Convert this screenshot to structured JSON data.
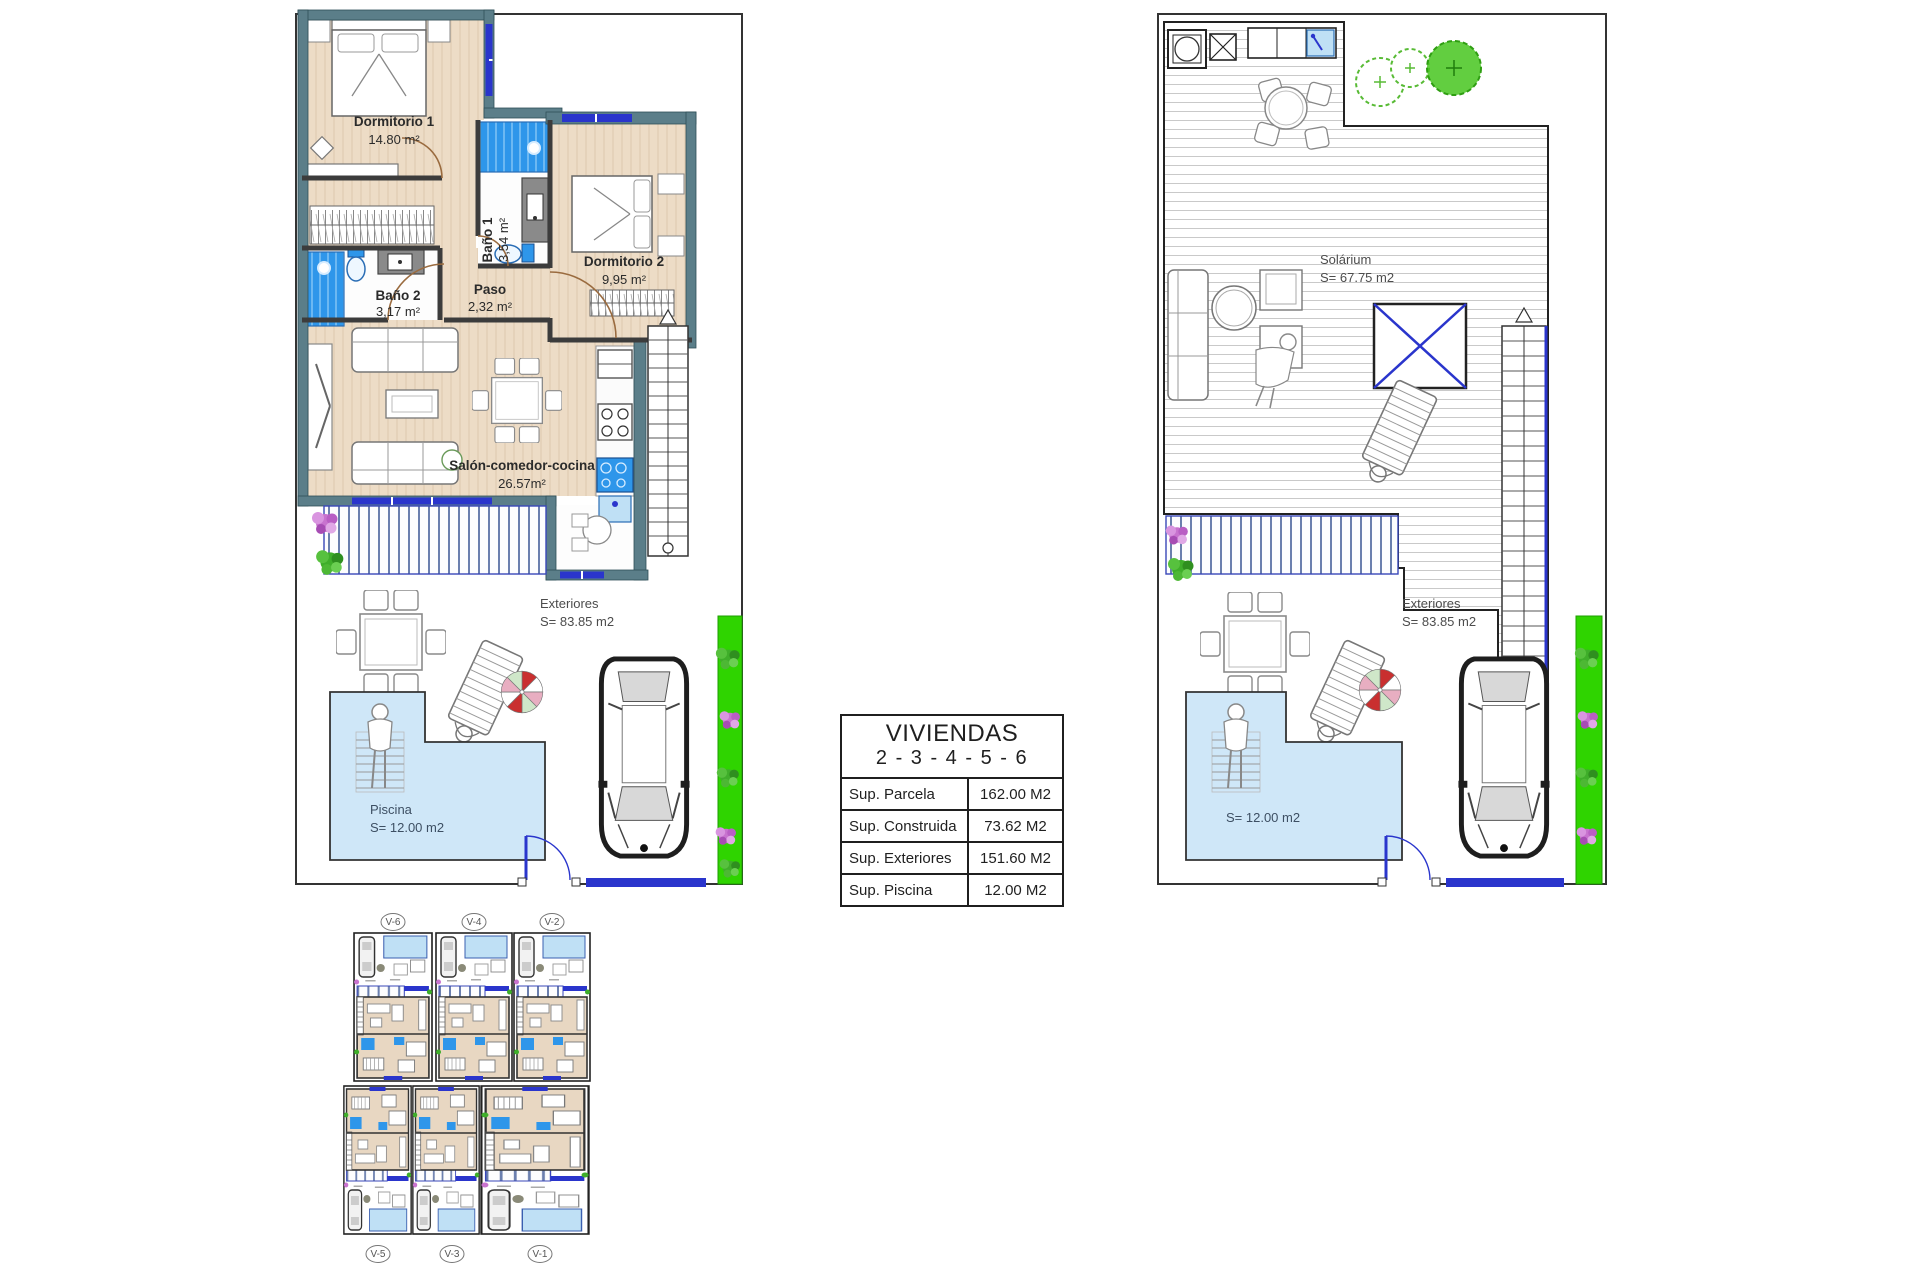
{
  "left_plan": {
    "rooms": {
      "dormitorio1": {
        "name": "Dormitorio 1",
        "area": "14.80 m²"
      },
      "bano1": {
        "name": "Baño 1",
        "area": "3,54 m²"
      },
      "dormitorio2": {
        "name": "Dormitorio 2",
        "area": "9,95 m²"
      },
      "bano2": {
        "name": "Baño 2",
        "area": "3,17 m²"
      },
      "paso": {
        "name": "Paso",
        "area": "2,32 m²"
      },
      "salon": {
        "name": "Salón-comedor-cocina",
        "area": "26.57m²"
      }
    },
    "exteriores": {
      "name": "Exteriores",
      "area": "S= 83.85 m2"
    },
    "piscina": {
      "name": "Piscina",
      "area": "S= 12.00 m2"
    }
  },
  "right_plan": {
    "solarium": {
      "name": "Solárium",
      "area": "S= 67.75 m2"
    },
    "exteriores": {
      "name": "Exteriores",
      "area": "S= 83.85 m2"
    },
    "pool_area": "S= 12.00 m2"
  },
  "summary_table": {
    "title": "VIVIENDAS",
    "subtitle": "2 - 3 - 4 - 5 - 6",
    "rows": [
      {
        "label": "Sup. Parcela",
        "value": "162.00 M2"
      },
      {
        "label": "Sup. Construida",
        "value": "73.62 M2"
      },
      {
        "label": "Sup. Exteriores",
        "value": "151.60 M2"
      },
      {
        "label": "Sup. Piscina",
        "value": "12.00 M2"
      }
    ]
  },
  "site_plan": {
    "units_top": [
      "V-6",
      "V-4",
      "V-2"
    ],
    "units_bottom": [
      "V-5",
      "V-3",
      "V-1"
    ]
  },
  "colors": {
    "wall_teal": "#5b7e89",
    "floor_beige": "#eddcc6",
    "tile_blue": "#2e96ea",
    "window_navy": "#2a35cc",
    "pool_blue": "#cfe7f8",
    "grass_green": "#2fd400",
    "umbrella_red": "#c92f2f",
    "umbrella_pink": "#e8aec1",
    "umbrella_green": "#cfe7c9"
  }
}
